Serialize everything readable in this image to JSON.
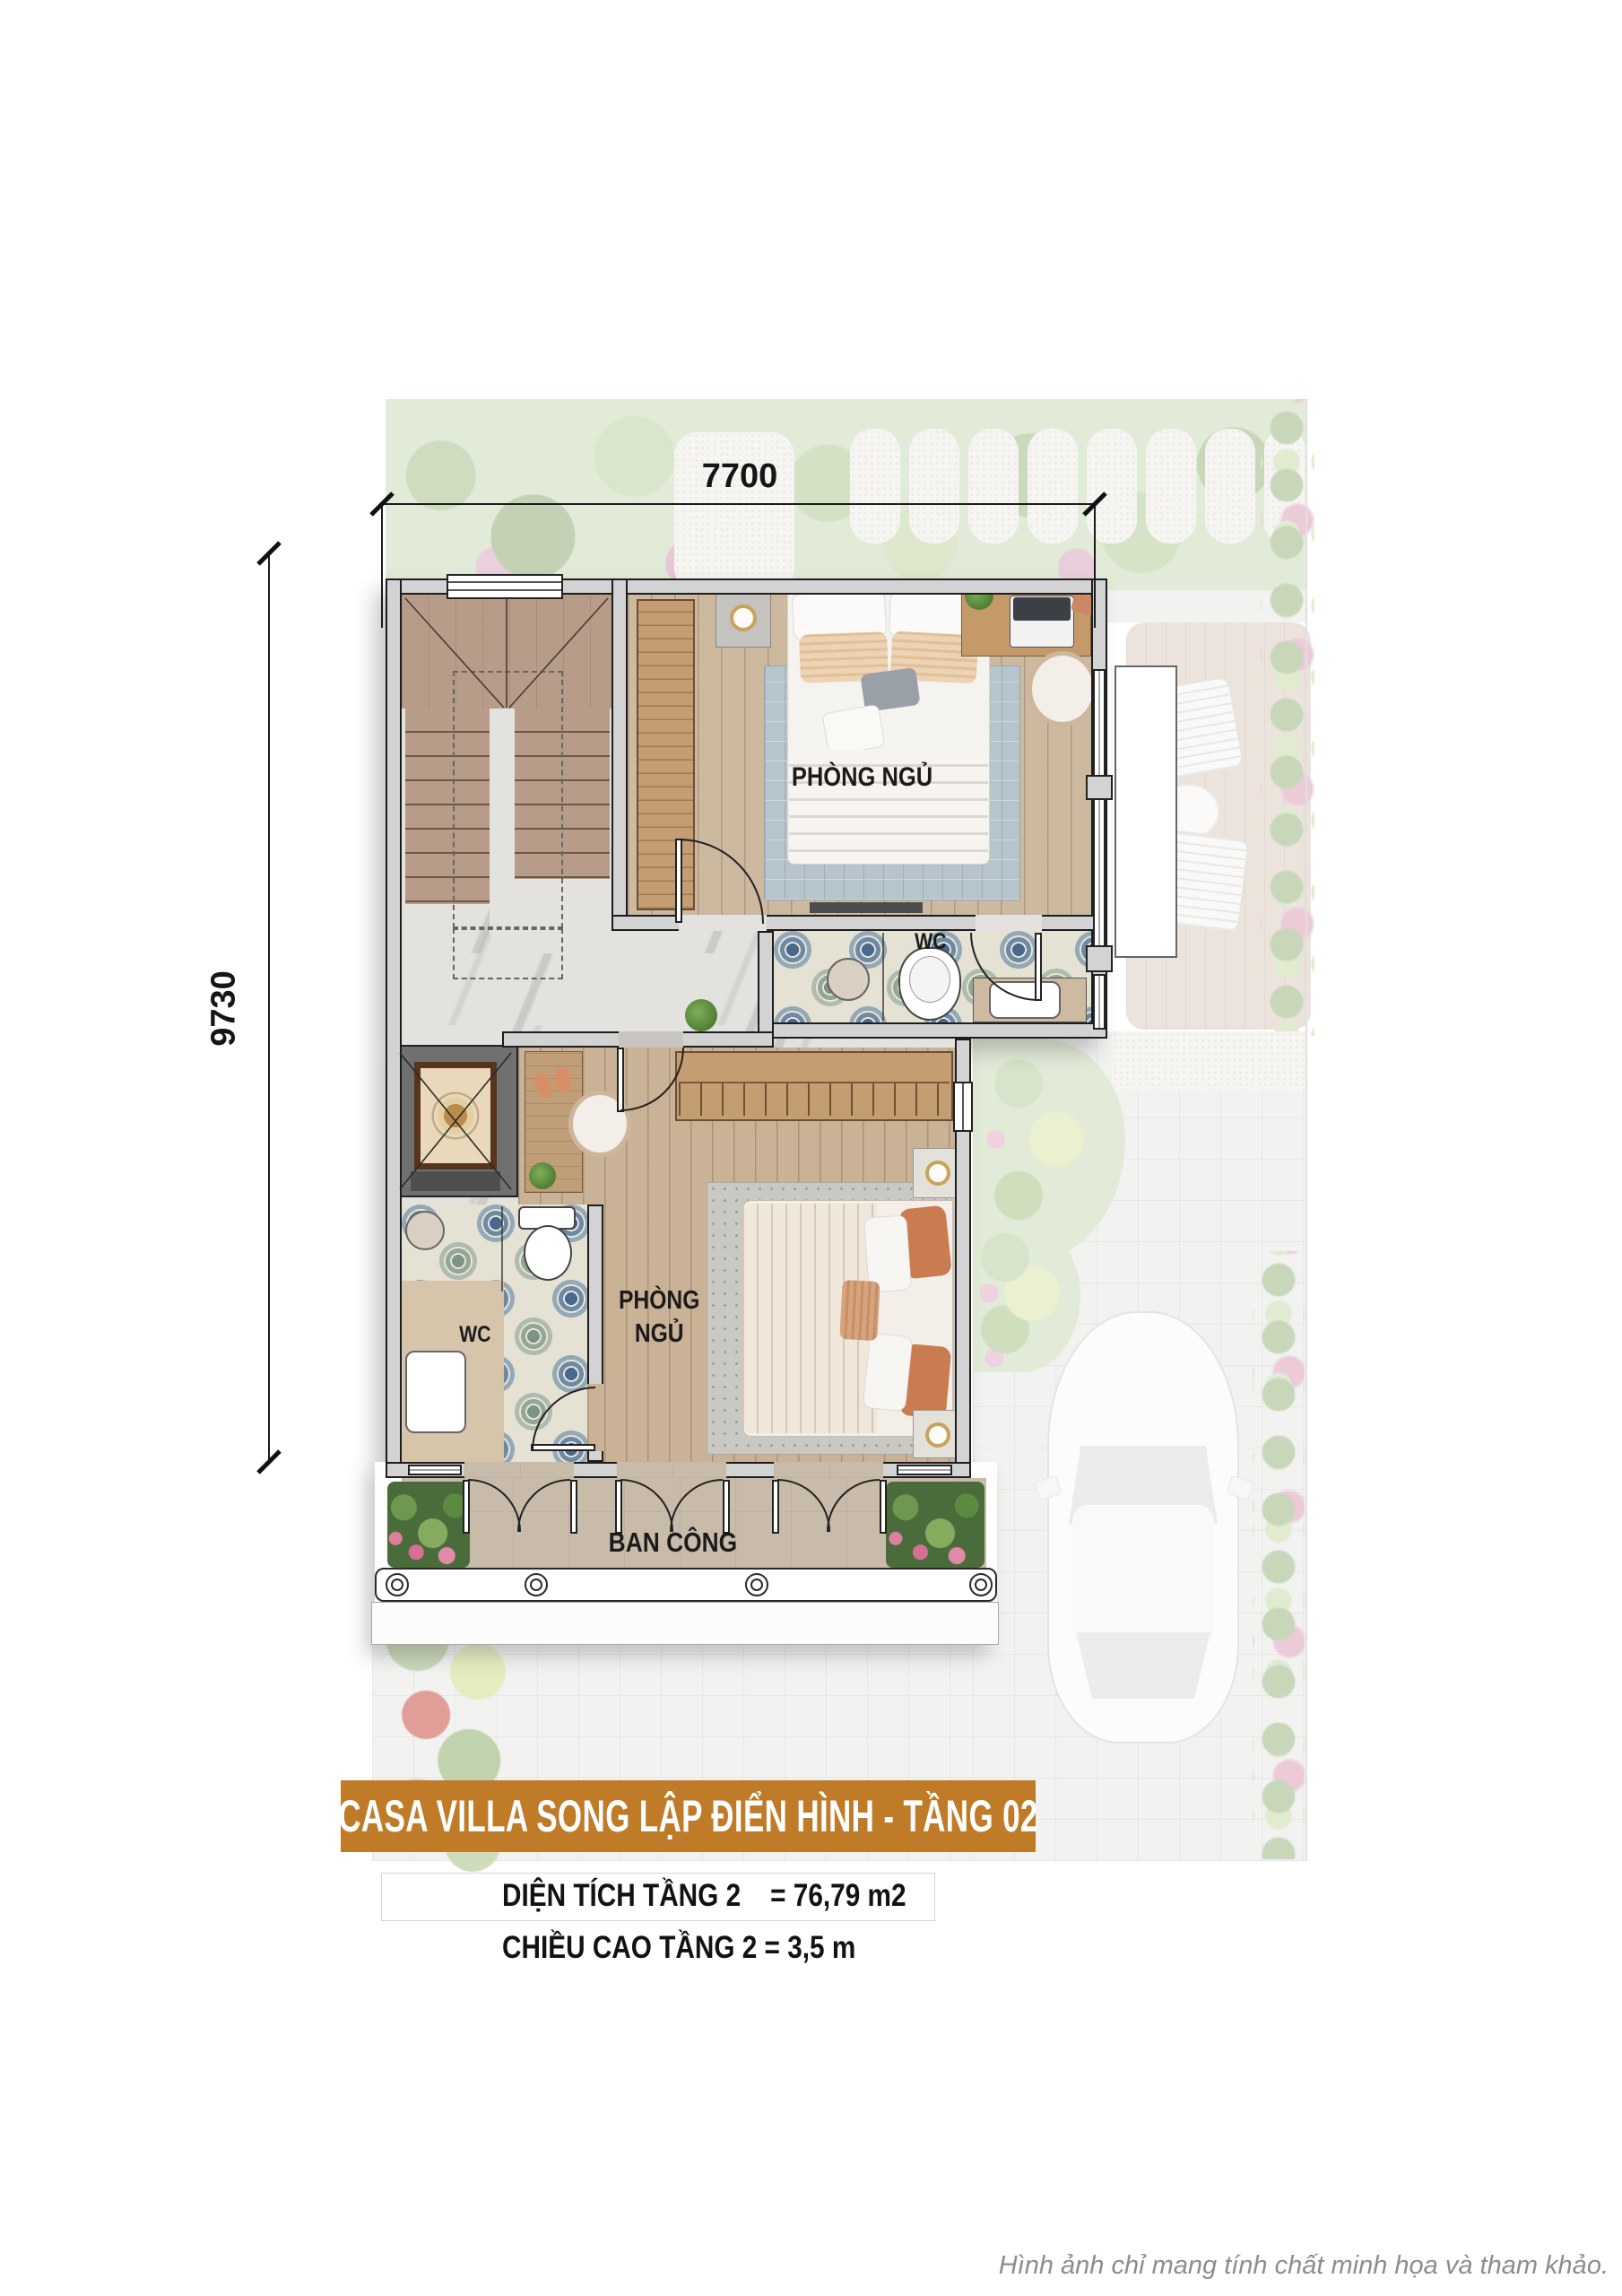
{
  "plan": {
    "dim_width": "7700",
    "dim_height": "9730",
    "rooms": {
      "bedroom1": "PHÒNG NGỦ",
      "bedroom2_line1": "PHÒNG",
      "bedroom2_line2": "NGỦ",
      "wc1": "WC",
      "wc2": "WC",
      "balcony": "BAN CÔNG"
    }
  },
  "caption": {
    "banner": "CASA VILLA SONG LẬP ĐIỂN HÌNH - TẦNG 02",
    "area": "DIỆN TÍCH TẦNG 2    = 76,79 m2",
    "height": "CHIỀU CAO TẦNG 2 = 3,5 m",
    "disclaimer": "Hình ảnh chỉ mang tính chất minh họa và tham khảo."
  },
  "colors": {
    "banner_bg": "#BF7B28",
    "wall_fill": "#D2D3D2",
    "wall_line": "#1D1D1D",
    "wood_floor": "#CDB8A0",
    "tile_blue": "#48688E",
    "marble": "#E4E2DF",
    "balcony_floor": "#C9BBAA",
    "text_dark": "#1C1C1C",
    "footer_gray": "#8D8D8D"
  }
}
